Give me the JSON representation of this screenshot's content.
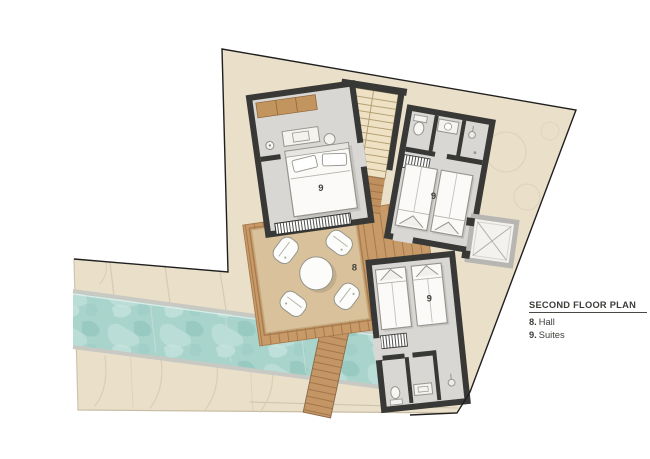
{
  "legend": {
    "title": "SECOND FLOOR PLAN",
    "items": [
      {
        "num": "8.",
        "label": "Hall"
      },
      {
        "num": "9.",
        "label": "Suites"
      }
    ]
  },
  "labels": {
    "hall": "8",
    "suite": "9"
  },
  "colors": {
    "plot": "#eadfc9",
    "pool": "#a9d4cc",
    "wood": "#c89a68",
    "rug": "#d9c29b",
    "wall": "#383836",
    "room_floor": "#d8d7d4",
    "stair": "#efe2c4",
    "text": "#3d3c38"
  }
}
